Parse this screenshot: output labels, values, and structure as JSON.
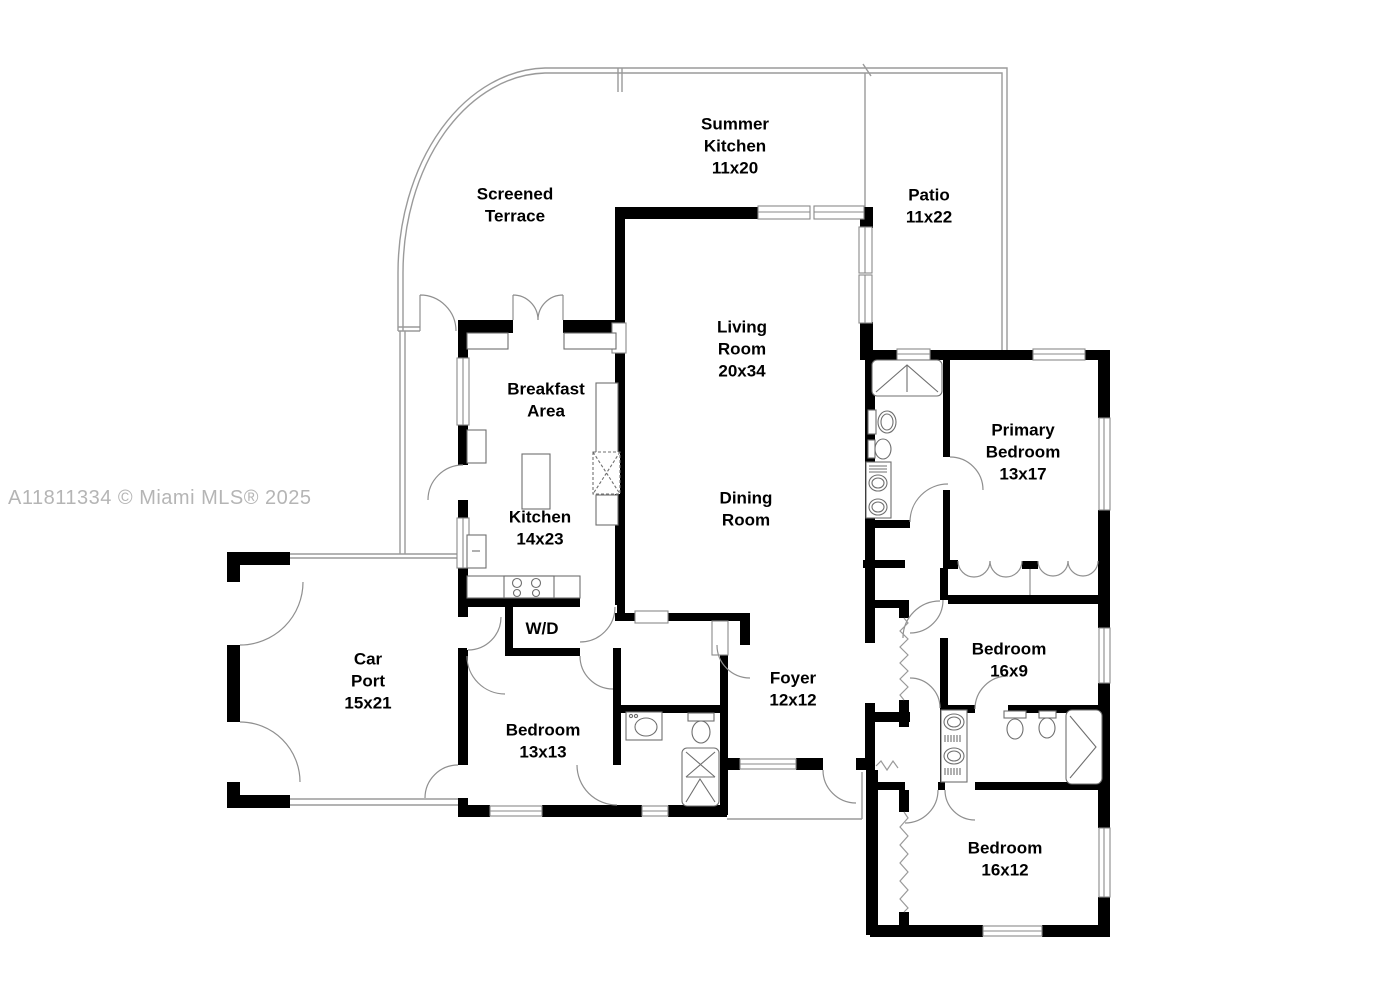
{
  "watermark": {
    "text": "A11811334 © Miami MLS® 2025"
  },
  "rooms": {
    "summer_kitchen": {
      "name": "Summer Kitchen",
      "dimensions": "11x20",
      "label": "Summer\nKitchen\n11x20"
    },
    "patio": {
      "name": "Patio",
      "dimensions": "11x22",
      "label": "Patio\n11x22"
    },
    "screened_terrace": {
      "name": "Screened Terrace",
      "dimensions": "",
      "label": "Screened\nTerrace"
    },
    "living_room": {
      "name": "Living Room",
      "dimensions": "20x34",
      "label": "Living\nRoom\n20x34"
    },
    "breakfast_area": {
      "name": "Breakfast Area",
      "dimensions": "",
      "label": "Breakfast\nArea"
    },
    "primary_bedroom": {
      "name": "Primary Bedroom",
      "dimensions": "13x17",
      "label": "Primary\nBedroom\n13x17"
    },
    "kitchen": {
      "name": "Kitchen",
      "dimensions": "14x23",
      "label": "Kitchen\n14x23"
    },
    "dining_room": {
      "name": "Dining Room",
      "dimensions": "",
      "label": "Dining\nRoom"
    },
    "car_port": {
      "name": "Car Port",
      "dimensions": "15x21",
      "label": "Car\nPort\n15x21"
    },
    "wd": {
      "name": "Washer/Dryer",
      "dimensions": "",
      "label": "W/D"
    },
    "foyer": {
      "name": "Foyer",
      "dimensions": "12x12",
      "label": "Foyer\n12x12"
    },
    "bedroom_13x13": {
      "name": "Bedroom",
      "dimensions": "13x13",
      "label": "Bedroom\n13x13"
    },
    "bedroom_16x9": {
      "name": "Bedroom",
      "dimensions": "16x9",
      "label": "Bedroom\n16x9"
    },
    "bedroom_16x12": {
      "name": "Bedroom",
      "dimensions": "16x12",
      "label": "Bedroom\n16x12"
    }
  },
  "fixtures": [
    "shower-icon",
    "bathtub-icon",
    "toilet-icon",
    "bidet-icon",
    "double-sink-vanity-icon",
    "single-sink-icon",
    "stove-icon",
    "refrigerator-icon",
    "kitchen-island",
    "closet-rod-zigzag",
    "door-swing-arc",
    "window",
    "bifold-closet-doors"
  ],
  "colors": {
    "wall": "#000000",
    "thin_line": "#9a9a9a",
    "door_arc": "#8f8f8f",
    "fixture_line": "#6f6f6f",
    "label_text": "#000000",
    "watermark": "#b5b5b5",
    "background": "#ffffff"
  }
}
